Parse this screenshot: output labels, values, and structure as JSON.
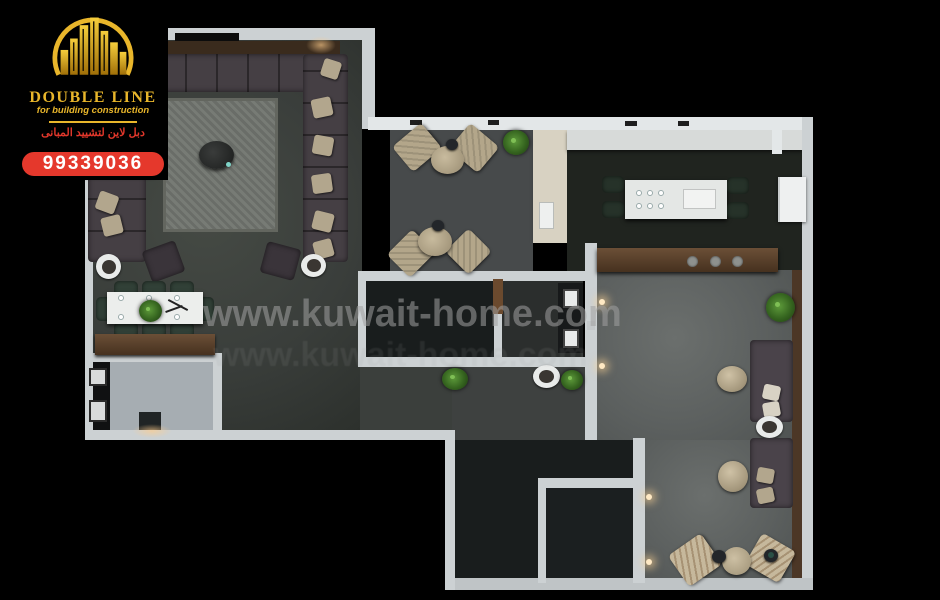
{
  "branding": {
    "company_name": "DOUBLE LINE",
    "tagline": "for building construction",
    "arabic_name": "دبل لاين لتشييد المبانى",
    "phone": "99339036",
    "colors": {
      "gold": "#E9B62B",
      "red": "#E5382C",
      "panel_black": "#000000"
    }
  },
  "watermark": {
    "text": "www.kuwait-home.com",
    "color": "#A0A0A0"
  },
  "palette": {
    "background": "#000000",
    "wall": "#CCD1D3",
    "wall_bright": "#E3E7E8",
    "wood": "#5A4230",
    "floor_living": "#3B3F3C",
    "floor_kitchen": "#20241F",
    "floor_lounge": "#5C605F",
    "floor_bath": "#A6ADB2",
    "floor_dark_room": "#191D1D",
    "sofa": "#453F44",
    "pillow": "#B2A68D",
    "chair_green": "#314037",
    "armchair_beige": "#B3A68A",
    "rug": "#70746E",
    "accent_light": "#FFE9C4"
  }
}
